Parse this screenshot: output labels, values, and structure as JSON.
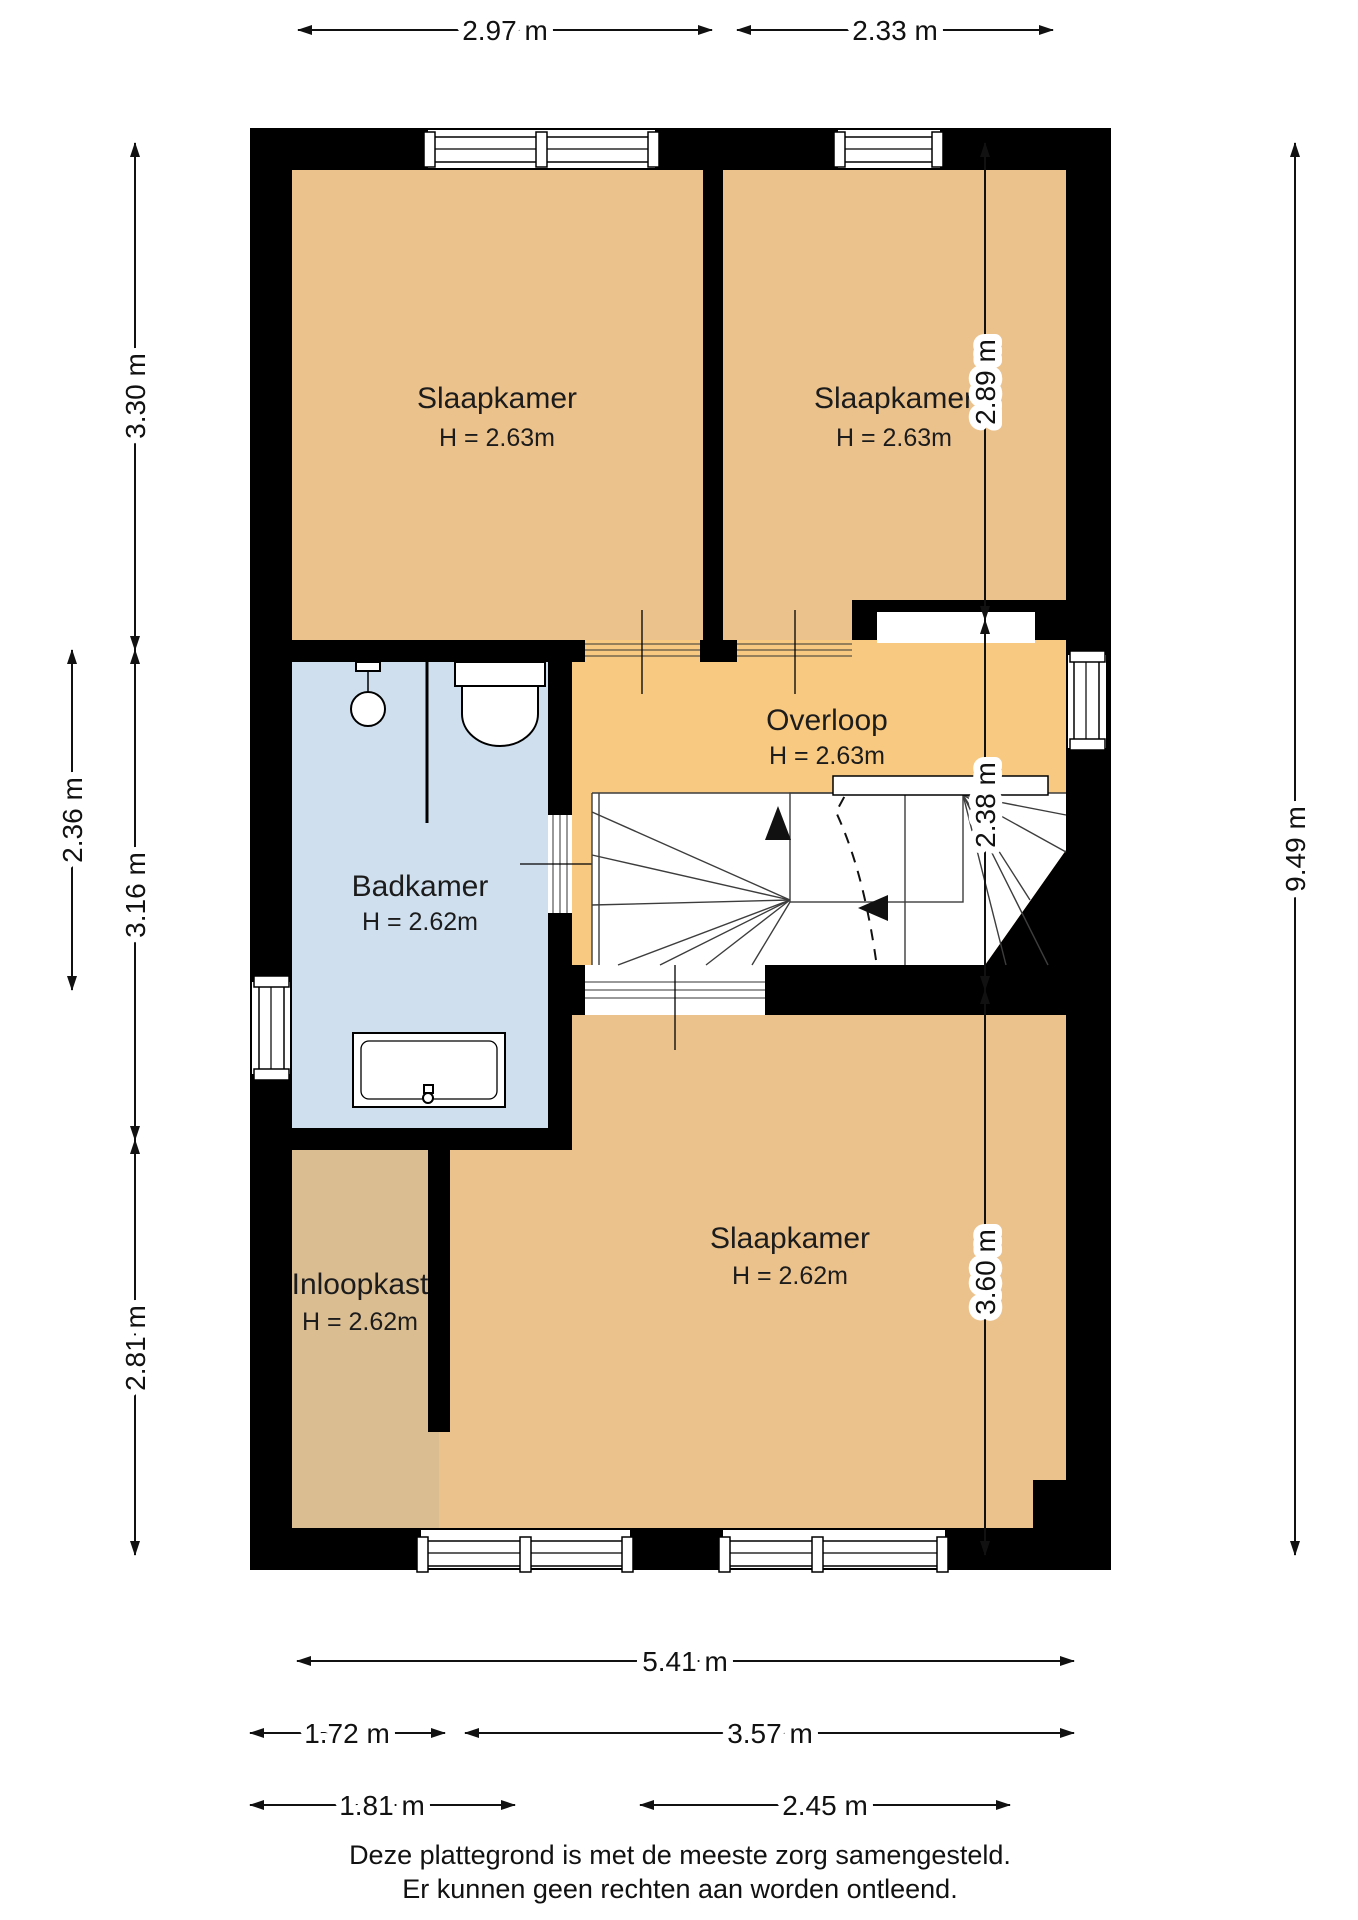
{
  "title": "Plattegrond verdieping",
  "colors": {
    "wall": "#000000",
    "floor_bedroom": "#ECC28C",
    "floor_hall": "#F7C981",
    "floor_closet": "#DBBD92",
    "floor_bath": "#CFDFEE",
    "accent_text": "#111111"
  },
  "rooms": [
    {
      "name": "Slaapkamer",
      "height_label": "H = 2.63m"
    },
    {
      "name": "Slaapkamer",
      "height_label": "H = 2.63m"
    },
    {
      "name": "Overloop",
      "height_label": "H = 2.63m"
    },
    {
      "name": "Badkamer",
      "height_label": "H = 2.62m"
    },
    {
      "name": "Slaapkamer",
      "height_label": "H = 2.62m"
    },
    {
      "name": "Inloopkast",
      "height_label": "H = 2.62m"
    }
  ],
  "dimensions": {
    "top": [
      "2.97 m",
      "2.33 m"
    ],
    "left": [
      "3.30 m",
      "2.36 m",
      "3.16 m",
      "2.81 m"
    ],
    "right": [
      "2.89 m",
      "2.38 m",
      "3.60 m",
      "9.49 m"
    ],
    "bottom": [
      "5.41 m",
      "1.72 m",
      "3.57 m",
      "1.81 m",
      "2.45 m"
    ]
  },
  "footer": [
    "Deze plattegrond is met de meeste zorg samengesteld.",
    "Er kunnen geen rechten aan worden ontleend."
  ]
}
